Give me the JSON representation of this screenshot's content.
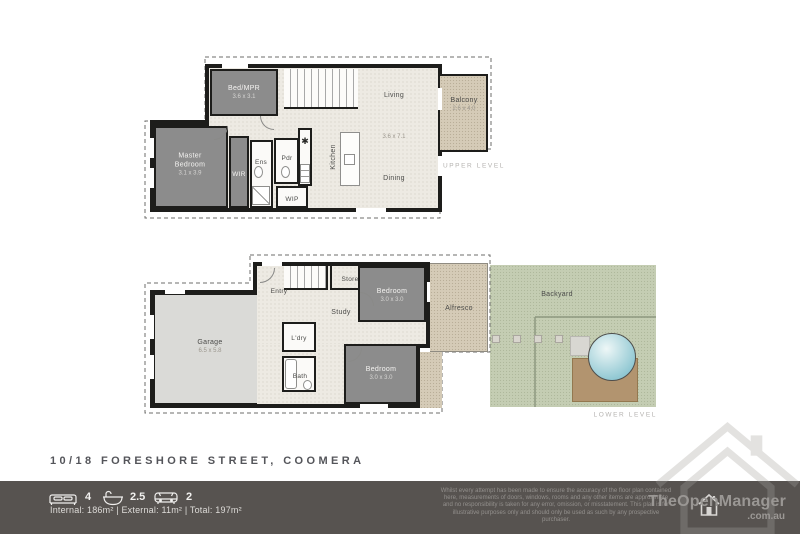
{
  "address": "10/18 FORESHORE STREET, COOMERA",
  "upper": {
    "level_label": "UPPER LEVEL",
    "bedmpr_name": "Bed/MPR",
    "bedmpr_dims": "3.6 x 3.1",
    "master_name": "Master Bedroom",
    "master_dims": "3.1 x 3.9",
    "wir": "WIR",
    "ens": "Ens",
    "pdr": "Pdr",
    "kitchen": "Kitchen",
    "kitchen_marker": "✱",
    "wip": "WIP",
    "living": "Living",
    "living_dining_dims": "3.6 x 7.1",
    "dining": "Dining",
    "balcony_name": "Balcony",
    "balcony_dims": "2.6 x 4.0"
  },
  "lower": {
    "level_label": "LOWER LEVEL",
    "garage_name": "Garage",
    "garage_dims": "6.5 x 5.8",
    "entry": "Entry",
    "store": "Store",
    "study": "Study",
    "bedroom1_name": "Bedroom",
    "bedroom1_dims": "3.0 x 3.0",
    "ldry": "L'dry",
    "bath": "Bath",
    "bedroom2_name": "Bedroom",
    "bedroom2_dims": "3.0 x 3.0",
    "alfresco": "Alfresco",
    "backyard": "Backyard"
  },
  "footer": {
    "beds": "4",
    "baths": "2.5",
    "cars": "2",
    "areas": "Internal: 186m² | External: 11m² | Total: 197m²",
    "disclaimer": "Whilst every attempt has been made to ensure the accuracy of the floor plan contained here, measurements of doors, windows, rooms and any other items are approximate and no responsibility is taken for any error, omission, or misstatement. This plan is for illustrative purposes only and should only be used as such by any prospective purchaser.",
    "brand": "TheOpenManager",
    "brand_suffix": ".com.au"
  },
  "colors": {
    "wall": "#1d1d1b",
    "dark_room": "#8c8c8c",
    "floor": "#edeae3",
    "garage": "#dadad7",
    "outdoor_tan": "#d5cbb7",
    "grass": "#c4cdb3",
    "pool": "#9fd0d8",
    "deck": "#b2946f",
    "footer_bar": "#575350"
  }
}
